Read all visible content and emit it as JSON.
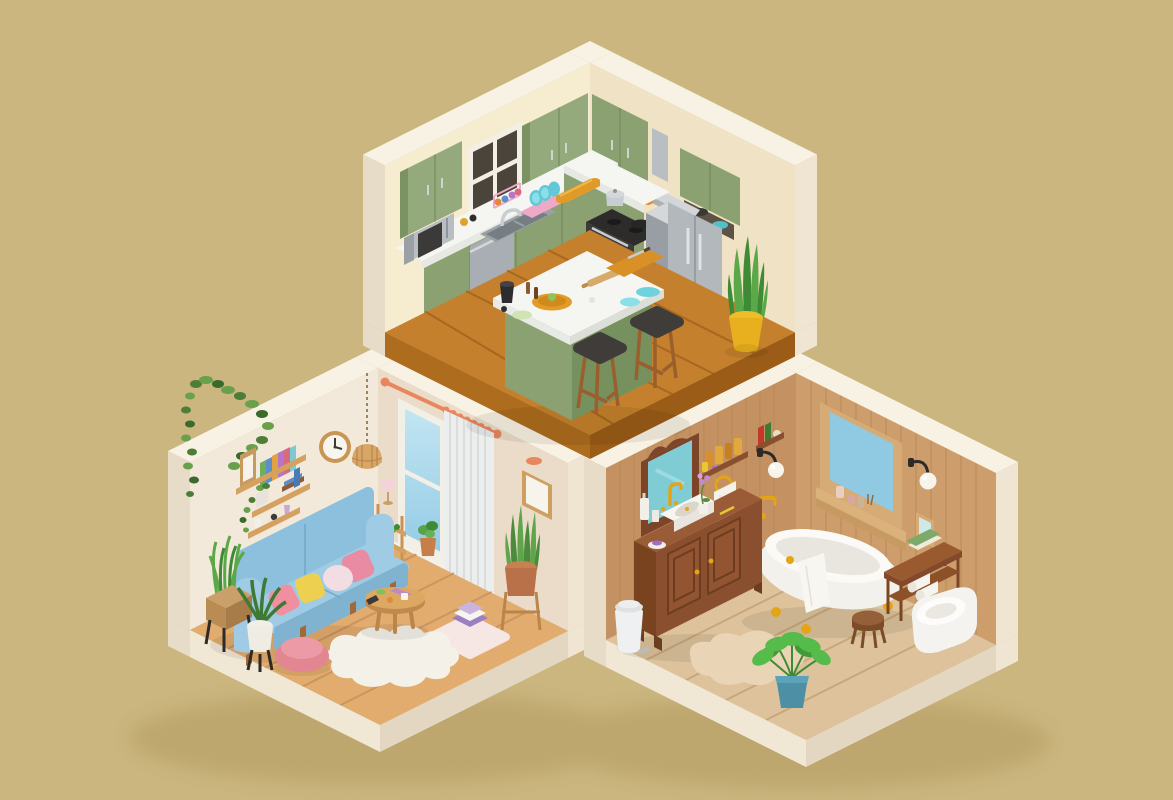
{
  "scene": {
    "type": "3d-isometric-diorama-render",
    "description": "Low-poly 3D render of three cutaway rooms - a kitchen on top, a living room at lower left and a bathroom at lower right - floating on a plain khaki background. No text is visible in the image.",
    "palette": {
      "background": "#cbb67f",
      "drop_shadow": "#a18548",
      "exterior_wall_top": "#f8f2e4",
      "exterior_cap_dark": "#e7dcc7",
      "exterior_cap_light": "#efe5d2"
    },
    "rooms": {
      "kitchen": {
        "label": "Kitchen",
        "position": "top-center",
        "walls": {
          "left": "#f6ecd0",
          "right": "#f0e2c4"
        },
        "floor": {
          "top": "#c5802d",
          "seams": "#a8661f",
          "base_left": "#ad6c1e",
          "base_right": "#9a5c16",
          "material": "orange wood planks"
        },
        "cabinets": {
          "light": "#94aa7d",
          "dark": "#7b9263",
          "style": "sage green"
        },
        "island": {
          "countertop": "#f5f6f2",
          "base": "#8ba172"
        },
        "appliance_steel": "#aab0b4",
        "items": [
          "window with dark panes",
          "green upper cabinets",
          "corner upper cabinet",
          "green base cabinets with white countertop",
          "silver microwave",
          "spice jars",
          "double steel sink with faucet",
          "cup rack with colorful mugs",
          "pink dish rack with blue plates",
          "orange bread box",
          "knife block",
          "hanging wooden board and utensils",
          "stainless range hood",
          "black stove with silver pot and black pan",
          "dishwasher",
          "stainless french-door fridge",
          "green cabinet above fridge with teal bowl",
          "kitchen island with pizza board, rolling pin, cutting board, knife, plates and black pitcher",
          "two bar stools with dark seats",
          "snake plant in yellow pot"
        ]
      },
      "living_room": {
        "label": "Living room",
        "position": "bottom-left",
        "walls": {
          "left": "#f2e9da",
          "right": "#eadcc8"
        },
        "floor": {
          "top": "#e2ac6e",
          "seams": "#cb9560",
          "base_left": "#f0e7d5",
          "base_right": "#e3d7c1",
          "material": "light wood planks"
        },
        "sofa": {
          "body": "#8cc0dc",
          "cushion": "#9fcce4",
          "front": "#7fb3d0",
          "pillows": [
            "#ef8fa0",
            "#eed051",
            "#f2dde2",
            "#e98ba2"
          ]
        },
        "curtain": "#eceded",
        "curtain_rod": "#e8875f",
        "rug": "#f4f1e9",
        "pouf": "#e28691",
        "items": [
          "hanging ivy in top corner",
          "wall clock with wood frame",
          "rattan pendant lamp on chain",
          "three wood wall shelves",
          "picture frame and colorful books on shelf",
          "trailing plant and book stack on shelf",
          "tiny ornaments on shelf",
          "tall window with sky view",
          "white curtain with copper rod and rings",
          "succulent pot on window sill",
          "picture frame with copper wall light",
          "ladder side table with pink lamp",
          "blue two-seat sofa with four pillows",
          "planter box with grasses on black stand",
          "white pot plant on black stand",
          "round wooden coffee table with cup, book, mug and phone",
          "white cloud-shaped rug",
          "pink pouf",
          "floor cushion with stacked books",
          "snake plant in terracotta pot on wood stand"
        ]
      },
      "bathroom": {
        "label": "Bathroom",
        "position": "bottom-right",
        "walls": {
          "left": "#c49262",
          "right": "#cd9d6b",
          "plank_line": "#b5854f",
          "material": "vertical wood planks"
        },
        "floor": {
          "top": "#ddc29c",
          "seams": "#c7a87c",
          "base_left": "#f0e7d5",
          "base_right": "#e3d7c1"
        },
        "vanity": {
          "front": "#8a4f2e",
          "side": "#7a431f",
          "top": "#9a5c36"
        },
        "tub": {
          "body": "#f3f1ec",
          "rim": "#fbfaf7",
          "gold": "#e3a417"
        },
        "mirror_glass": "#7fccd4",
        "window_glass": "#8fc9e2",
        "items": [
          "ornate dark-wood mirror",
          "shelf with amber bottles and cream tube",
          "small shelf with red and green books and candle",
          "black sconce with white globe (left wall)",
          "gold towel ring with white towel",
          "dark wood vanity with two doors and gold knobs",
          "white basin with gold faucet",
          "soap pump, cup and purple soap dish",
          "purple orchid in white pot",
          "yellow toothbrush",
          "white pedal trash can",
          "white clawfoot bathtub with gold feet and gold floor faucet",
          "towel draped over tub",
          "wood-framed window with candles on sill",
          "black sconce with white globe (right wall)",
          "small picture frame",
          "wooden bench with books and rolled towels",
          "wall-hung white toilet",
          "small round wood stool",
          "beige blob rug",
          "green plant in teal pot"
        ]
      }
    }
  }
}
